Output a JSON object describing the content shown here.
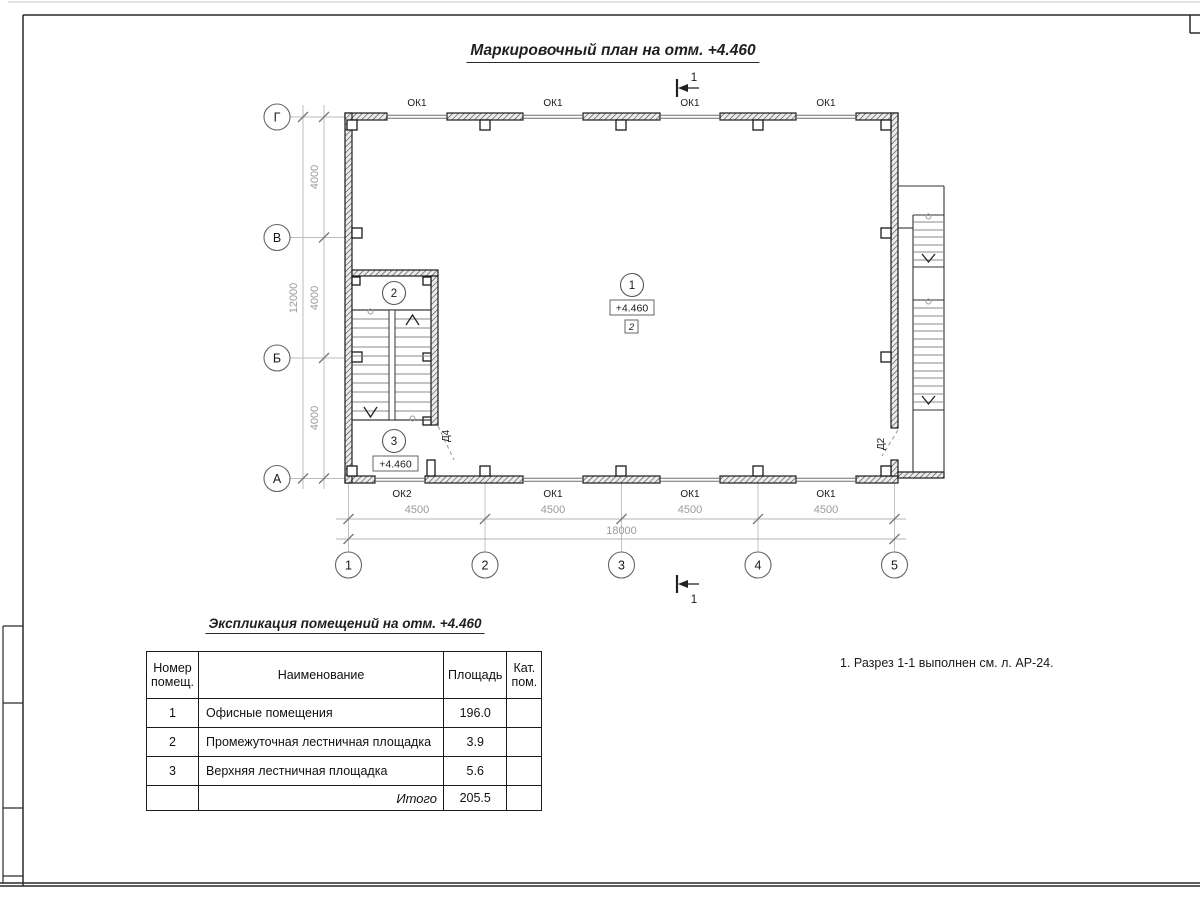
{
  "sheet": {
    "title": "Маркировочный план на отм. +4.460",
    "note": "1. Разрез 1-1 выполнен см. л. АР-24."
  },
  "plan": {
    "elevation": "+4.460",
    "category": "2",
    "section_mark": "1",
    "axes_rows": [
      "Г",
      "В",
      "Б",
      "А"
    ],
    "axes_cols": [
      "1",
      "2",
      "3",
      "4",
      "5"
    ],
    "row_dims": [
      "4000",
      "4000",
      "4000"
    ],
    "row_total": "12000",
    "col_dims": [
      "4500",
      "4500",
      "4500",
      "4500"
    ],
    "col_total": "18000",
    "top_windows": [
      "ОК1",
      "ОК1",
      "ОК1",
      "ОК1"
    ],
    "bottom_windows": [
      "ОК2",
      "ОК1",
      "ОК1",
      "ОК1"
    ],
    "doors": {
      "d4": "Д4",
      "d2": "Д2"
    },
    "rooms": [
      {
        "num": "1"
      },
      {
        "num": "2"
      },
      {
        "num": "3"
      }
    ]
  },
  "table": {
    "title": "Экспликация помещений на отм. +4.460",
    "headers": {
      "num": "Номер помещ.",
      "name": "Наименование",
      "area": "Площадь",
      "cat": "Кат. пом."
    },
    "rows": [
      {
        "num": "1",
        "name": "Офисные помещения",
        "area": "196.0",
        "cat": ""
      },
      {
        "num": "2",
        "name": "Промежуточная лестничная площадка",
        "area": "3.9",
        "cat": ""
      },
      {
        "num": "3",
        "name": "Верхняя лестничная площадка",
        "area": "5.6",
        "cat": ""
      }
    ],
    "total_label": "Итого",
    "total_area": "205.5"
  },
  "colors": {
    "line_dark": "#1a1a1a",
    "dim_grey": "#9a9a9a",
    "wall_hatch": "#404040"
  }
}
